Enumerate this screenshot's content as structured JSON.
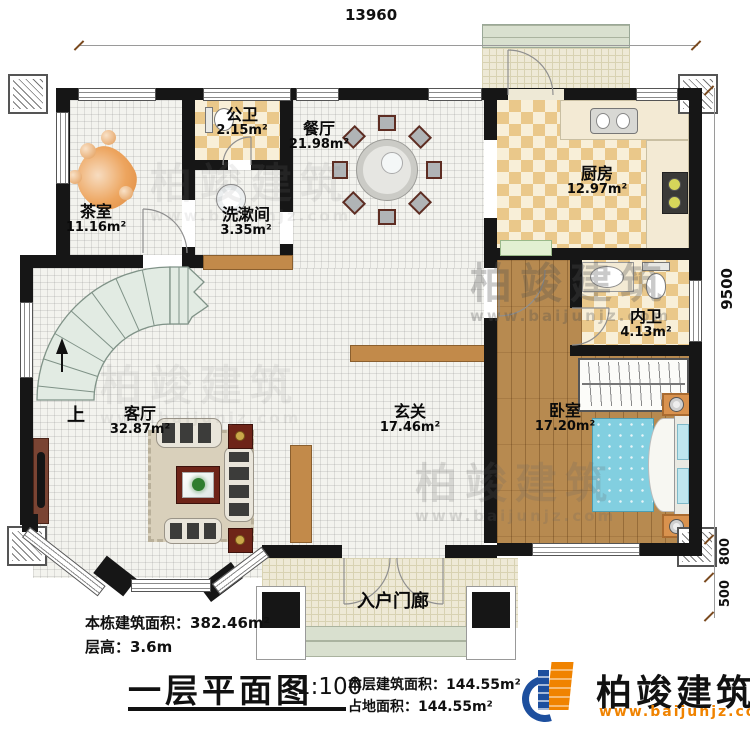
{
  "rooms": [
    {
      "name": "茶室",
      "area": "11.16m²"
    },
    {
      "name": "公卫",
      "area": "2.15m²"
    },
    {
      "name": "洗漱间",
      "area": "3.35m²"
    },
    {
      "name": "餐厅",
      "area": "21.98m²"
    },
    {
      "name": "厨房",
      "area": "12.97m²"
    },
    {
      "name": "内卫",
      "area": "4.13m²"
    },
    {
      "name": "卧室",
      "area": "17.20m²"
    },
    {
      "name": "玄关",
      "area": "17.46m²"
    },
    {
      "name": "客厅",
      "area": "32.87m²"
    },
    {
      "name": "入户门廊",
      "area": ""
    }
  ],
  "stairs": {
    "up_label": "上"
  },
  "dimensions": {
    "top_width": "13960",
    "right_height": "9500",
    "porch_depth": "800",
    "step_depth": "500"
  },
  "footer": {
    "building_total_area": "本栋建筑面积：382.46m²",
    "floor_height": "层高：3.6m",
    "title": "一层平面图",
    "scale": "1:100",
    "floor_area": "本层建筑面积：144.55m²",
    "footprint_area": "占地面积：144.55m²"
  },
  "logo": {
    "name": "柏竣建筑",
    "website": "www.baijunjz.com"
  },
  "watermark": {
    "text": "柏竣建筑",
    "url": "www.baijunjz.com"
  },
  "colors": {
    "wall": "#161616",
    "tile": "#f3f3ee",
    "checker_light": "#f8efd8",
    "checker_dark": "#eac88a",
    "wood": "#b78a50",
    "stair_fill": "#e2ebe3",
    "stair_line": "#7f9287",
    "porch_floor": "#eee9d6",
    "step": "#d9e0cf",
    "marble": "#f3ead4",
    "bed_blue": "#82cfe0",
    "orange_furn": "#d9924e",
    "dark_red": "#6e2418",
    "brown_bar": "#c28a4a",
    "rug": "#d9d0bb",
    "sofa": "#e9e5da",
    "logo_orange": "#f08300",
    "logo_blue": "#1d4f9e"
  }
}
